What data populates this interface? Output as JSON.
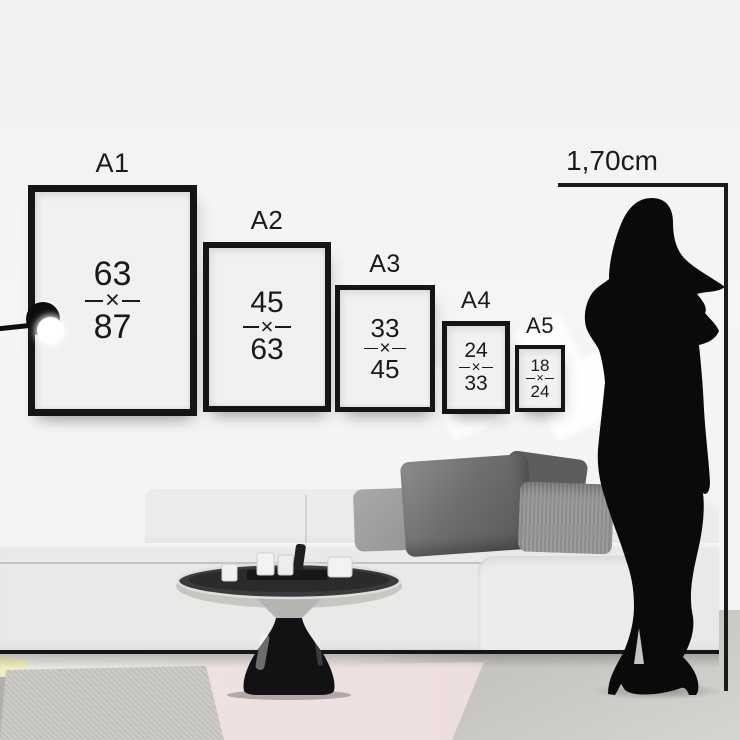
{
  "measurement": {
    "height_label": "1,70cm"
  },
  "frames": [
    {
      "label": "A1",
      "width_cm": "63",
      "separator": "×",
      "height_cm": "87"
    },
    {
      "label": "A2",
      "width_cm": "45",
      "separator": "×",
      "height_cm": "63"
    },
    {
      "label": "A3",
      "width_cm": "33",
      "separator": "×",
      "height_cm": "45"
    },
    {
      "label": "A4",
      "width_cm": "24",
      "separator": "×",
      "height_cm": "33"
    },
    {
      "label": "A5",
      "width_cm": "18",
      "separator": "×",
      "height_cm": "24"
    }
  ],
  "icons": {
    "person": "woman-silhouette",
    "lamp": "wall-lamp",
    "separator_glyph": "multiply-x"
  },
  "colors": {
    "wall": "#f1f1ef",
    "frame": "#151515",
    "paper": "#f1f1ef",
    "text": "#1a1a1a",
    "sofa": "#eae9e7",
    "sofa_light": "#ecebe9",
    "floor": "#a9a8a4",
    "rug_pink": "#f1e3e3",
    "rug_gray": "#c8c6c3",
    "rug_yellow": "#f2edbe",
    "silhouette": "#0a0a0a"
  }
}
